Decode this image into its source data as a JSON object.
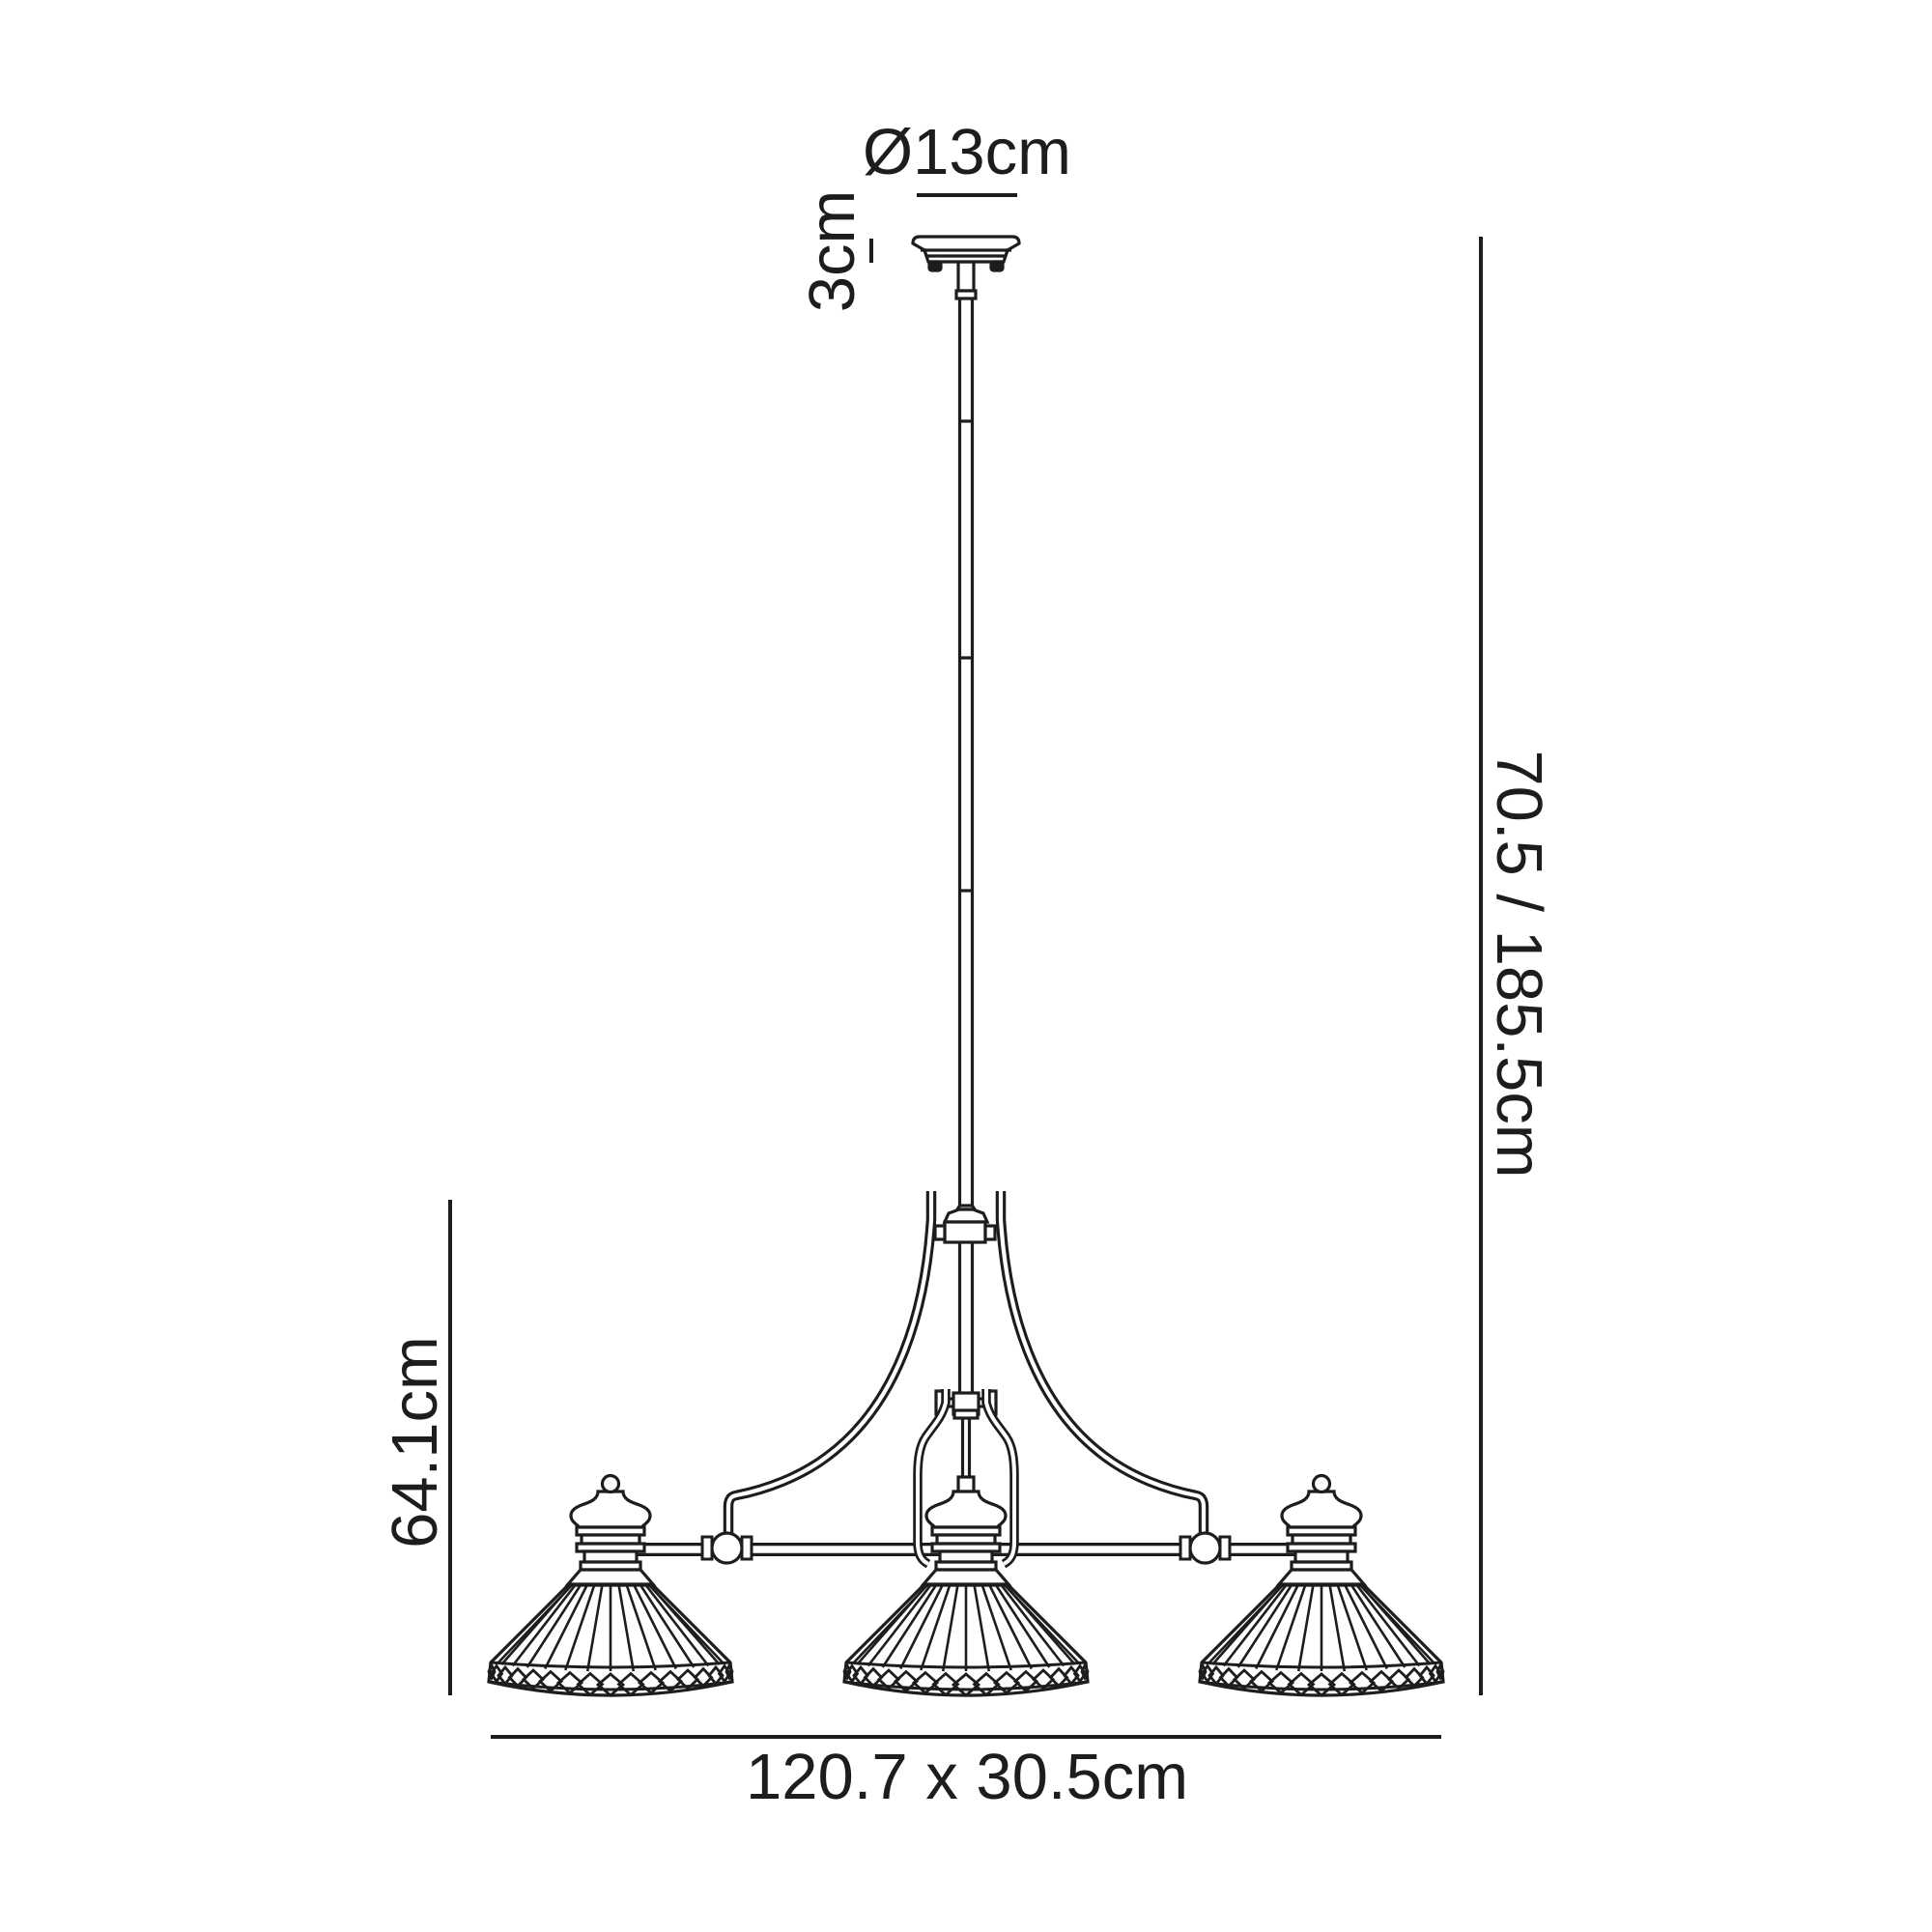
{
  "diagram": {
    "kind": "product dimension line drawing",
    "subject": "3-light linear pendant with ribbed cone shades and diamond-band rims",
    "background_color": "#ffffff",
    "line_color": "#1e1c1d"
  },
  "labels": {
    "canopy_diameter": "Ø13cm",
    "canopy_height": "3cm",
    "overall_height": "70.5 / 185.5cm",
    "frame_drop": "64.1cm",
    "fixture_size": "120.7 x 30.5cm"
  }
}
